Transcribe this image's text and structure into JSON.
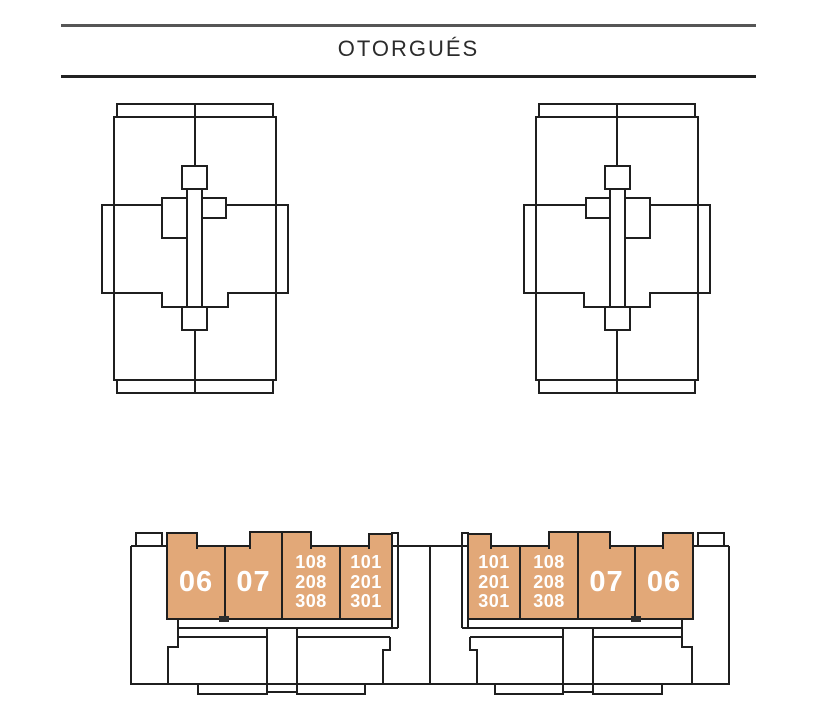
{
  "street": {
    "name": "OTORGUÉS"
  },
  "colors": {
    "unit_fill": "#E2A878",
    "unit_text": "#FFFFFF",
    "line": "#1F1F1F"
  },
  "plan": {
    "left_block": {
      "units": [
        {
          "id": "06",
          "label": "06"
        },
        {
          "id": "07",
          "label": "07"
        },
        {
          "id": "108-208-308",
          "label": "108\n208\n308"
        },
        {
          "id": "101-201-301",
          "label": "101\n201\n301"
        }
      ]
    },
    "right_block": {
      "units": [
        {
          "id": "101-201-301",
          "label": "101\n201\n301"
        },
        {
          "id": "108-208-308",
          "label": "108\n208\n308"
        },
        {
          "id": "07",
          "label": "07"
        },
        {
          "id": "06",
          "label": "06"
        }
      ]
    }
  }
}
